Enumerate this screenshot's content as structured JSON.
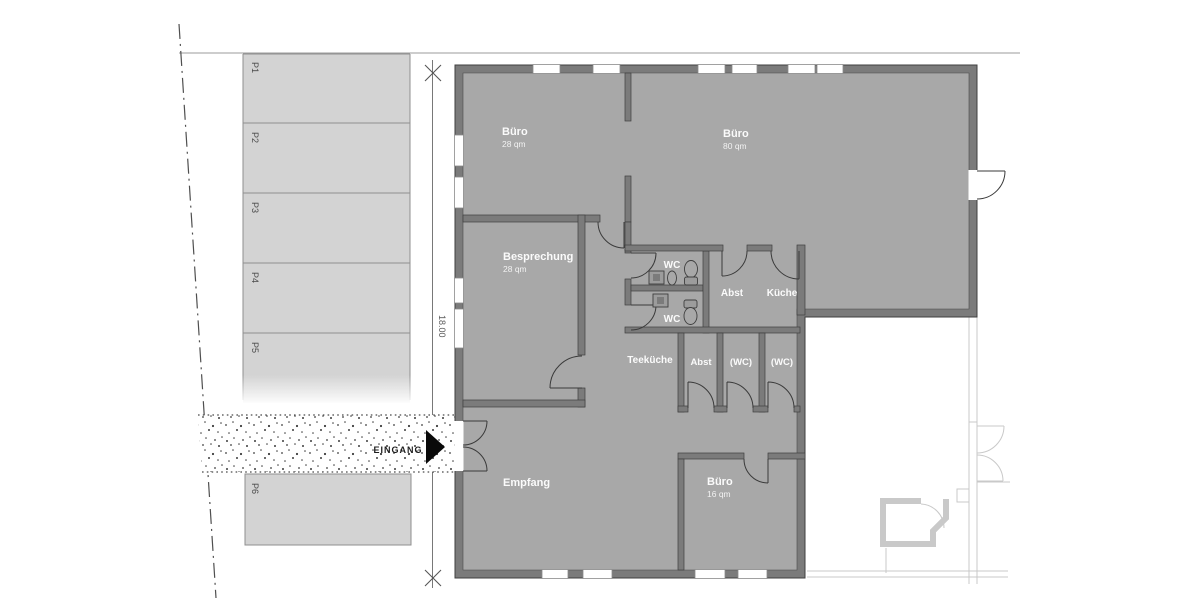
{
  "site": {
    "parking_spaces": [
      "P1",
      "P2",
      "P3",
      "P4",
      "P5",
      "P6"
    ],
    "entrance_label": "EINGANG",
    "dimension_label": "18.00"
  },
  "rooms": {
    "buero_28": {
      "name": "Büro",
      "area": "28 qm"
    },
    "buero_80": {
      "name": "Büro",
      "area": "80 qm"
    },
    "besprechung": {
      "name": "Besprechung",
      "area": "28 qm"
    },
    "wc_upper": {
      "name": "WC"
    },
    "wc_lower": {
      "name": "WC"
    },
    "abst_upper": {
      "name": "Abst"
    },
    "kueche": {
      "name": "Küche"
    },
    "teekueche": {
      "name": "Teeküche"
    },
    "abst_hall": {
      "name": "Abst"
    },
    "wc_hall_left": {
      "name": "(WC)"
    },
    "wc_hall_right": {
      "name": "(WC)"
    },
    "empfang": {
      "name": "Empfang"
    },
    "buero_16": {
      "name": "Büro",
      "area": "16 qm"
    }
  },
  "colors": {
    "floor": "#a8a8a8",
    "wall": "#7b7b7b",
    "wall_outline": "#3f3f3f",
    "parking_fill": "#d3d3d3",
    "parking_border": "#8f8f8f",
    "neighbor_faint": "#c9c9c9",
    "room_text": "#fbfbfb",
    "site_text": "#4a4a4a",
    "entrance_arrow": "#0a0a0a",
    "background": "#ffffff"
  }
}
